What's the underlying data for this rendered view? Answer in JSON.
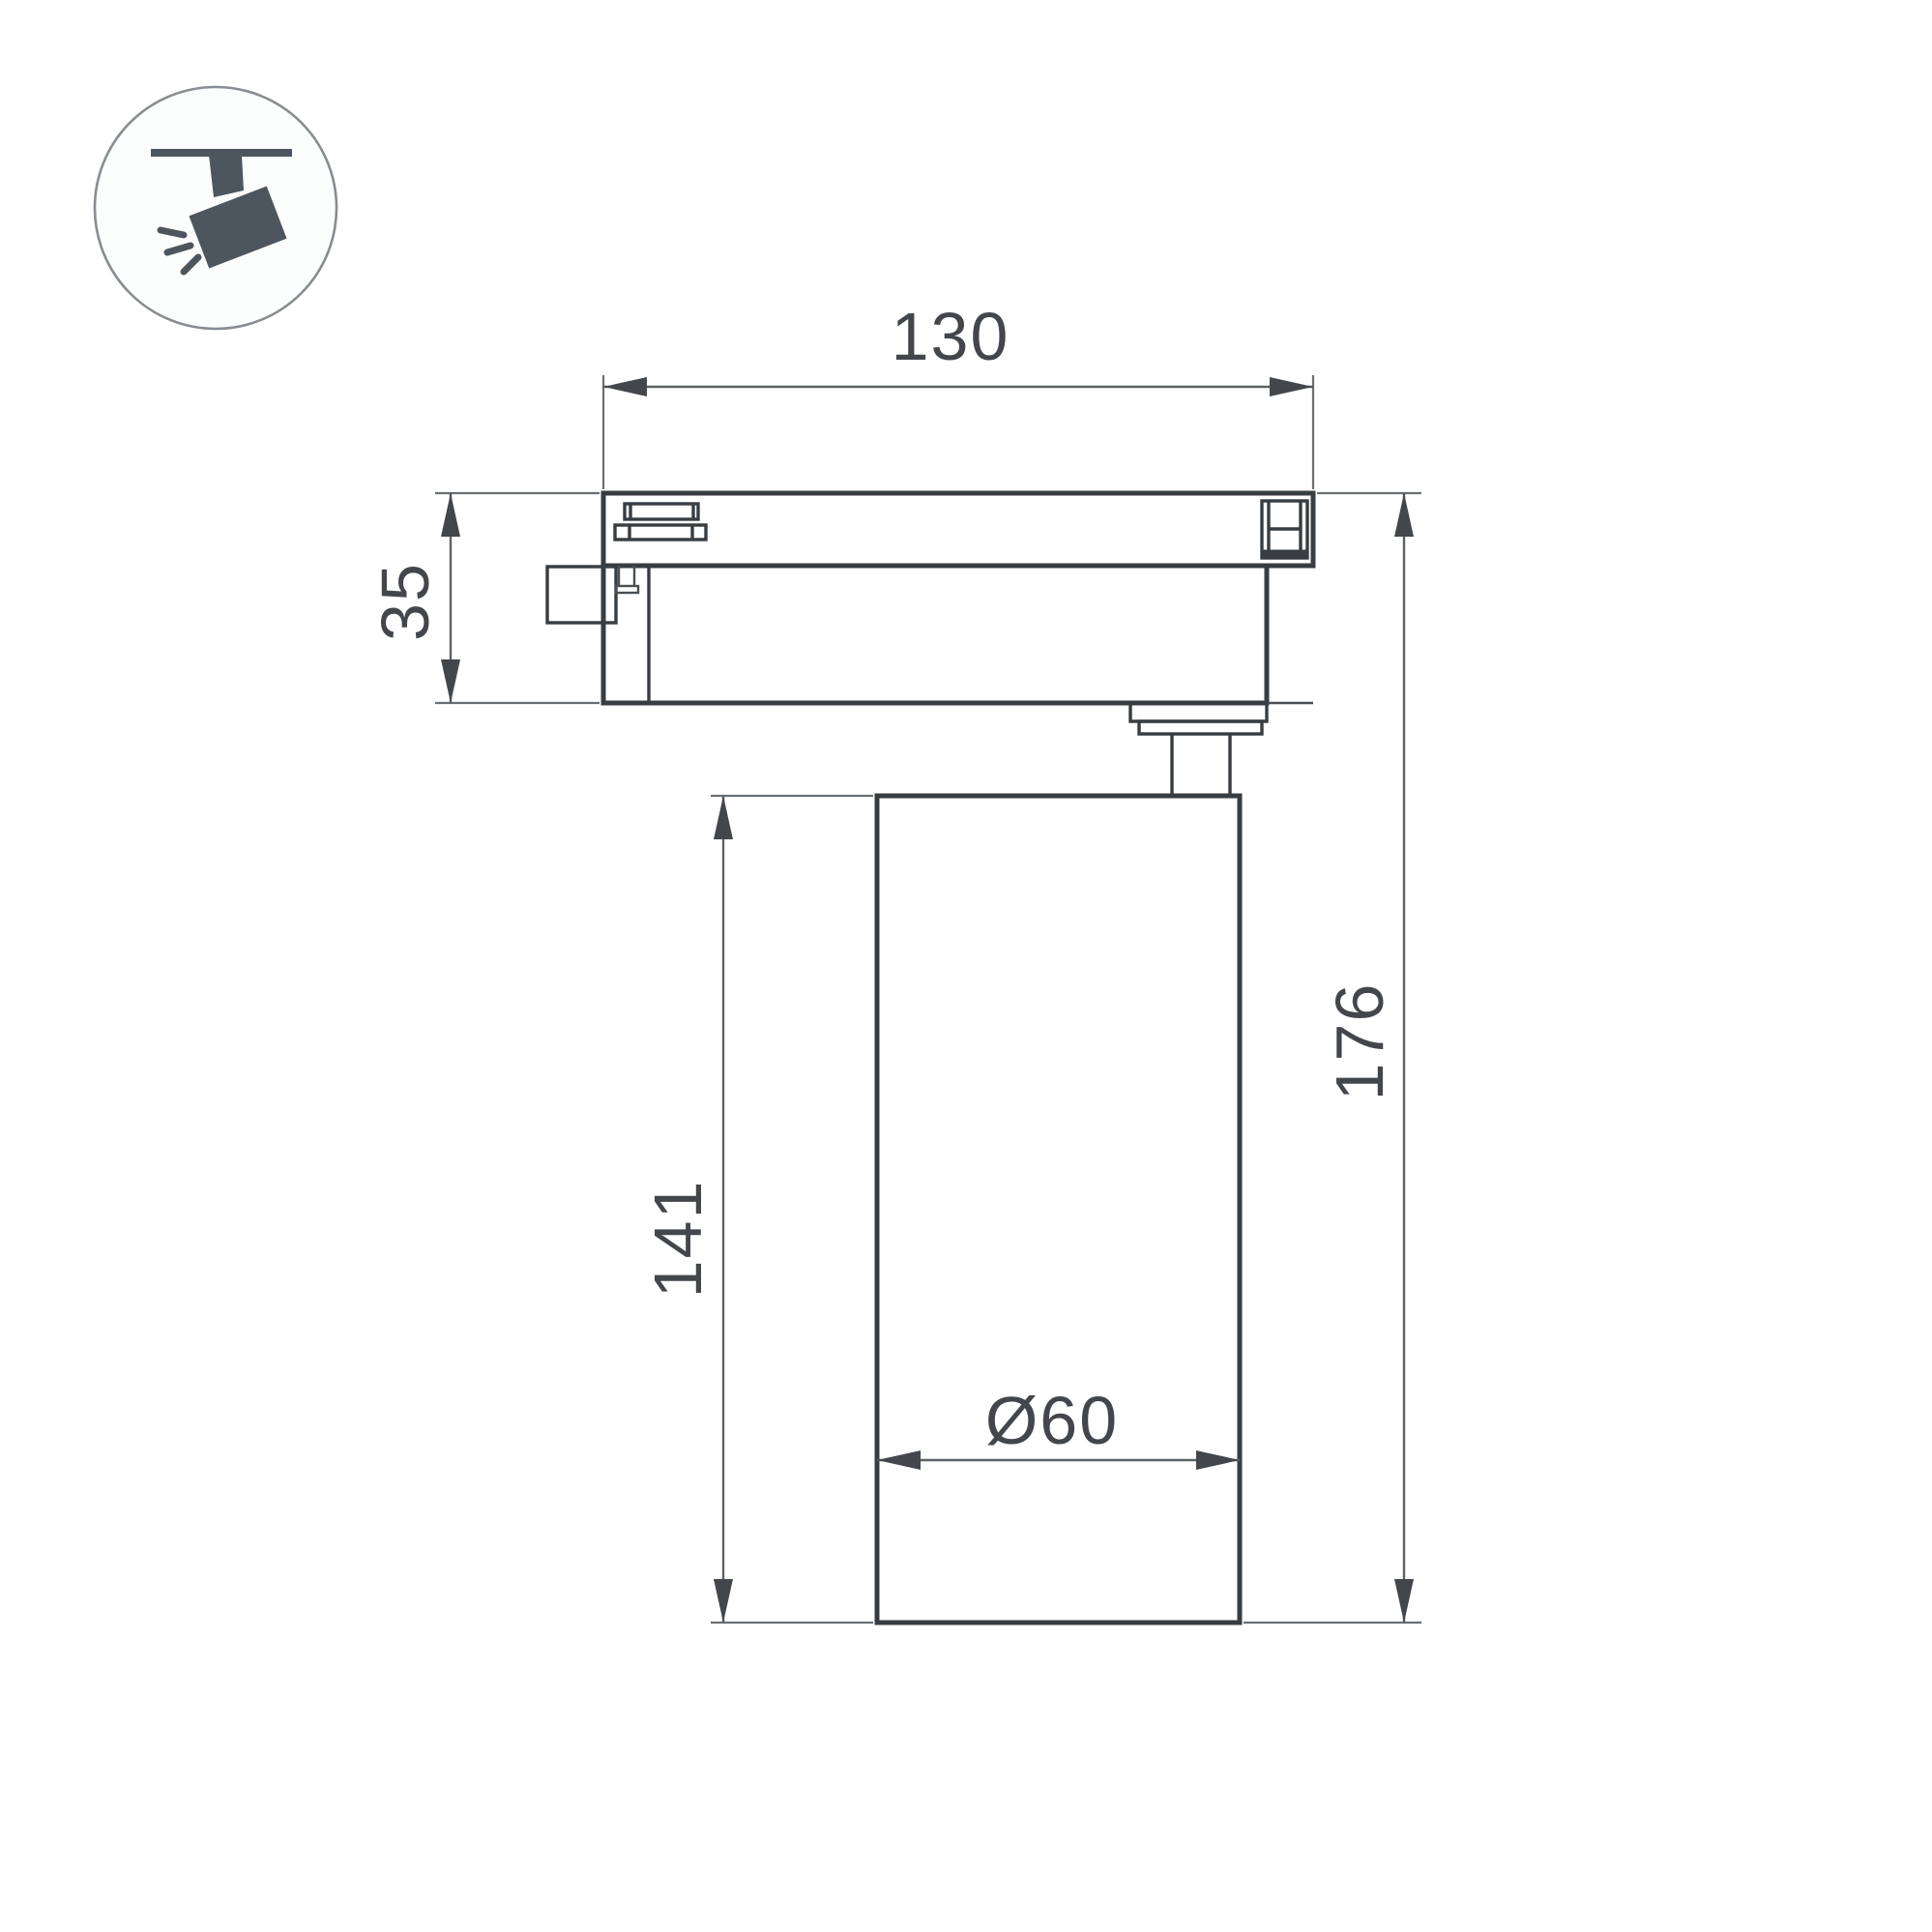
{
  "drawing": {
    "type": "technical dimension drawing",
    "subject": "track-mounted spotlight luminaire (side view)",
    "ink_color": "#383d42",
    "dimension_color": "#5d6266",
    "background_color": "#ffffff",
    "dimensions": {
      "track_adapter_width": "130",
      "track_adapter_height": "35",
      "lamp_body_height": "141",
      "total_height": "176",
      "lamp_body_diameter": "Ø60"
    },
    "icon": {
      "name": "track-spotlight-icon"
    }
  }
}
